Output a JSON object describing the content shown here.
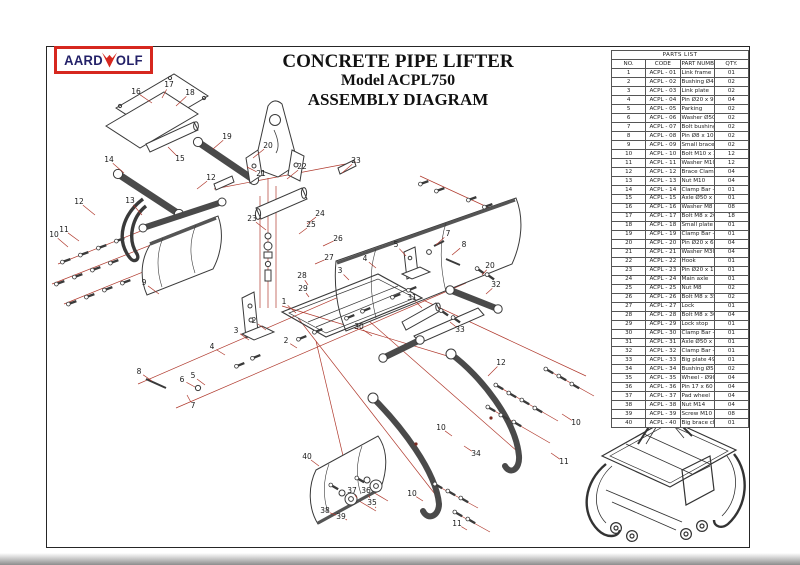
{
  "logo": {
    "left": "AARD",
    "right": "OLF",
    "icon": "wolf-head-icon",
    "border_color": "#d6281f",
    "text_color": "#232168"
  },
  "title": {
    "line1": "CONCRETE PIPE LIFTER",
    "line2": "Model ACPL750",
    "line3": "ASSEMBLY DIAGRAM"
  },
  "parts_list": {
    "title": "PARTS LIST",
    "columns": [
      "NO.",
      "CODE",
      "PART NUMBER",
      "QTY."
    ],
    "rows": [
      [
        "1",
        "ACPL - 01",
        "Link frame",
        "01"
      ],
      [
        "2",
        "ACPL - 02",
        "Bushing Ø40 x 16",
        "02"
      ],
      [
        "3",
        "ACPL - 03",
        "Link plate",
        "02"
      ],
      [
        "4",
        "ACPL - 04",
        "Pin Ø20 x 91",
        "04"
      ],
      [
        "5",
        "ACPL - 05",
        "Parking",
        "02"
      ],
      [
        "6",
        "ACPL - 06",
        "Washer Ø50 x 6",
        "02"
      ],
      [
        "7",
        "ACPL - 07",
        "Bolt bushing M16",
        "02"
      ],
      [
        "8",
        "ACPL - 08",
        "Pin Ø8 x 100",
        "02"
      ],
      [
        "9",
        "ACPL - 09",
        "Small brace channel",
        "02"
      ],
      [
        "10",
        "ACPL - 10",
        "Bolt M10 x 35",
        "12"
      ],
      [
        "11",
        "ACPL - 11",
        "Washer M10",
        "12"
      ],
      [
        "12",
        "ACPL - 12",
        "Brace Clamp",
        "04"
      ],
      [
        "13",
        "ACPL - 13",
        "Nut M10",
        "04"
      ],
      [
        "14",
        "ACPL - 14",
        "Clamp Bar - 01",
        "01"
      ],
      [
        "15",
        "ACPL - 15",
        "Axle Ø50 x 464",
        "01"
      ],
      [
        "16",
        "ACPL - 16",
        "Washer M8",
        "08"
      ],
      [
        "17",
        "ACPL - 17",
        "Bolt M8 x 20",
        "18"
      ],
      [
        "18",
        "ACPL - 18",
        "Small plate 464",
        "01"
      ],
      [
        "19",
        "ACPL - 19",
        "Clamp Bar - 02",
        "01"
      ],
      [
        "20",
        "ACPL - 20",
        "Pin Ø20 x 69",
        "04"
      ],
      [
        "21",
        "ACPL - 21",
        "Washer M30",
        "04"
      ],
      [
        "22",
        "ACPL - 22",
        "Hook",
        "01"
      ],
      [
        "23",
        "ACPL - 23",
        "Pin Ø20 x 103",
        "01"
      ],
      [
        "24",
        "ACPL - 24",
        "Main axle",
        "01"
      ],
      [
        "25",
        "ACPL - 25",
        "Nut M8",
        "02"
      ],
      [
        "26",
        "ACPL - 26",
        "Bolt M8 x 35",
        "02"
      ],
      [
        "27",
        "ACPL - 27",
        "Lock",
        "01"
      ],
      [
        "28",
        "ACPL - 28",
        "Bolt M8 x 30",
        "04"
      ],
      [
        "29",
        "ACPL - 29",
        "Lock stop",
        "01"
      ],
      [
        "30",
        "ACPL - 30",
        "Clamp Bar - 03",
        "01"
      ],
      [
        "31",
        "ACPL - 31",
        "Axle Ø50 x 496",
        "01"
      ],
      [
        "32",
        "ACPL - 32",
        "Clamp Bar - 04",
        "01"
      ],
      [
        "33",
        "ACPL - 33",
        "Big plate 496",
        "01"
      ],
      [
        "34",
        "ACPL - 34",
        "Bushing Ø50 x 16.5",
        "02"
      ],
      [
        "35",
        "ACPL - 35",
        "Wheel - Ø90 x 50",
        "04"
      ],
      [
        "36",
        "ACPL - 36",
        "Pin 17 x 60 - M14",
        "04"
      ],
      [
        "37",
        "ACPL - 37",
        "Pad wheel",
        "04"
      ],
      [
        "38",
        "ACPL - 38",
        "Nut M14",
        "04"
      ],
      [
        "39",
        "ACPL - 39",
        "Screw M10 x 14",
        "08"
      ],
      [
        "40",
        "ACPL - 40",
        "Big brace channel",
        "01"
      ]
    ]
  },
  "diagram": {
    "leader_color": "#b03a2e",
    "ink_color": "#3a3a3a",
    "labels": [
      {
        "t": "16",
        "x": 90,
        "y": 46,
        "ex": 106,
        "ey": 57
      },
      {
        "t": "17",
        "x": 123,
        "y": 39,
        "ex": 116,
        "ey": 52
      },
      {
        "t": "18",
        "x": 144,
        "y": 47,
        "ex": 130,
        "ey": 60
      },
      {
        "t": "19",
        "x": 181,
        "y": 91,
        "ex": 167,
        "ey": 103
      },
      {
        "t": "20",
        "x": 222,
        "y": 100,
        "ex": 207,
        "ey": 112
      },
      {
        "t": "21",
        "x": 215,
        "y": 128,
        "ex": 201,
        "ey": 121
      },
      {
        "t": "14",
        "x": 63,
        "y": 114,
        "ex": 78,
        "ey": 127
      },
      {
        "t": "15",
        "x": 134,
        "y": 113,
        "ex": 122,
        "ey": 101
      },
      {
        "t": "12",
        "x": 165,
        "y": 132,
        "ex": 151,
        "ey": 143
      },
      {
        "t": "22",
        "x": 256,
        "y": 121,
        "ex": 241,
        "ey": 133
      },
      {
        "t": "23",
        "x": 310,
        "y": 115,
        "ex": 296,
        "ey": 127
      },
      {
        "t": "23",
        "x": 206,
        "y": 173,
        "ex": 220,
        "ey": 184
      },
      {
        "t": "24",
        "x": 274,
        "y": 168,
        "ex": 261,
        "ey": 178
      },
      {
        "t": "25",
        "x": 265,
        "y": 179,
        "ex": 253,
        "ey": 188
      },
      {
        "t": "26",
        "x": 292,
        "y": 193,
        "ex": 277,
        "ey": 200
      },
      {
        "t": "27",
        "x": 283,
        "y": 212,
        "ex": 269,
        "ey": 218
      },
      {
        "t": "12",
        "x": 33,
        "y": 156,
        "ex": 49,
        "ey": 169
      },
      {
        "t": "13",
        "x": 84,
        "y": 155,
        "ex": 96,
        "ey": 169
      },
      {
        "t": "11",
        "x": 18,
        "y": 184,
        "ex": 33,
        "ey": 195
      },
      {
        "t": "10",
        "x": 8,
        "y": 189,
        "ex": 22,
        "ey": 201
      },
      {
        "t": "9",
        "x": 98,
        "y": 237,
        "ex": 113,
        "ey": 248
      },
      {
        "t": "28",
        "x": 256,
        "y": 230,
        "ex": 262,
        "ey": 239
      },
      {
        "t": "29",
        "x": 257,
        "y": 243,
        "ex": 263,
        "ey": 251
      },
      {
        "t": "1",
        "x": 238,
        "y": 256,
        "ex": 250,
        "ey": 267
      },
      {
        "t": "2",
        "x": 208,
        "y": 275,
        "ex": 220,
        "ey": 284
      },
      {
        "t": "3",
        "x": 190,
        "y": 285,
        "ex": 203,
        "ey": 294
      },
      {
        "t": "4",
        "x": 166,
        "y": 301,
        "ex": 179,
        "ey": 309
      },
      {
        "t": "2",
        "x": 240,
        "y": 295,
        "ex": 251,
        "ey": 302
      },
      {
        "t": "3",
        "x": 294,
        "y": 225,
        "ex": 303,
        "ey": 234
      },
      {
        "t": "4",
        "x": 319,
        "y": 213,
        "ex": 330,
        "ey": 222
      },
      {
        "t": "5",
        "x": 147,
        "y": 330,
        "ex": 159,
        "ey": 339
      },
      {
        "t": "6",
        "x": 136,
        "y": 334,
        "ex": 149,
        "ey": 341
      },
      {
        "t": "7",
        "x": 147,
        "y": 360,
        "ex": 141,
        "ey": 349
      },
      {
        "t": "8",
        "x": 93,
        "y": 326,
        "ex": 106,
        "ey": 335
      },
      {
        "t": "5",
        "x": 350,
        "y": 199,
        "ex": 360,
        "ey": 210
      },
      {
        "t": "7",
        "x": 402,
        "y": 188,
        "ex": 390,
        "ey": 199
      },
      {
        "t": "8",
        "x": 418,
        "y": 199,
        "ex": 406,
        "ey": 209
      },
      {
        "t": "20",
        "x": 444,
        "y": 220,
        "ex": 436,
        "ey": 229
      },
      {
        "t": "32",
        "x": 450,
        "y": 239,
        "ex": 440,
        "ey": 248
      },
      {
        "t": "31",
        "x": 366,
        "y": 252,
        "ex": 376,
        "ey": 262
      },
      {
        "t": "30",
        "x": 313,
        "y": 281,
        "ex": 326,
        "ey": 290
      },
      {
        "t": "33",
        "x": 414,
        "y": 284,
        "ex": 404,
        "ey": 276
      },
      {
        "t": "12",
        "x": 455,
        "y": 317,
        "ex": 442,
        "ey": 330
      },
      {
        "t": "10",
        "x": 395,
        "y": 382,
        "ex": 406,
        "ey": 390
      },
      {
        "t": "34",
        "x": 430,
        "y": 408,
        "ex": 418,
        "ey": 400
      },
      {
        "t": "10",
        "x": 530,
        "y": 377,
        "ex": 516,
        "ey": 368
      },
      {
        "t": "11",
        "x": 518,
        "y": 416,
        "ex": 505,
        "ey": 407
      },
      {
        "t": "10",
        "x": 366,
        "y": 448,
        "ex": 377,
        "ey": 455
      },
      {
        "t": "11",
        "x": 411,
        "y": 478,
        "ex": 421,
        "ey": 484
      },
      {
        "t": "40",
        "x": 261,
        "y": 411,
        "ex": 273,
        "ey": 420
      },
      {
        "t": "37",
        "x": 306,
        "y": 445,
        "ex": 311,
        "ey": 452
      },
      {
        "t": "36",
        "x": 320,
        "y": 445,
        "ex": 324,
        "ey": 452
      },
      {
        "t": "35",
        "x": 326,
        "y": 457,
        "ex": 330,
        "ey": 462
      },
      {
        "t": "38",
        "x": 279,
        "y": 465,
        "ex": 290,
        "ey": 469
      },
      {
        "t": "39",
        "x": 295,
        "y": 471,
        "ex": 301,
        "ey": 474
      }
    ]
  }
}
